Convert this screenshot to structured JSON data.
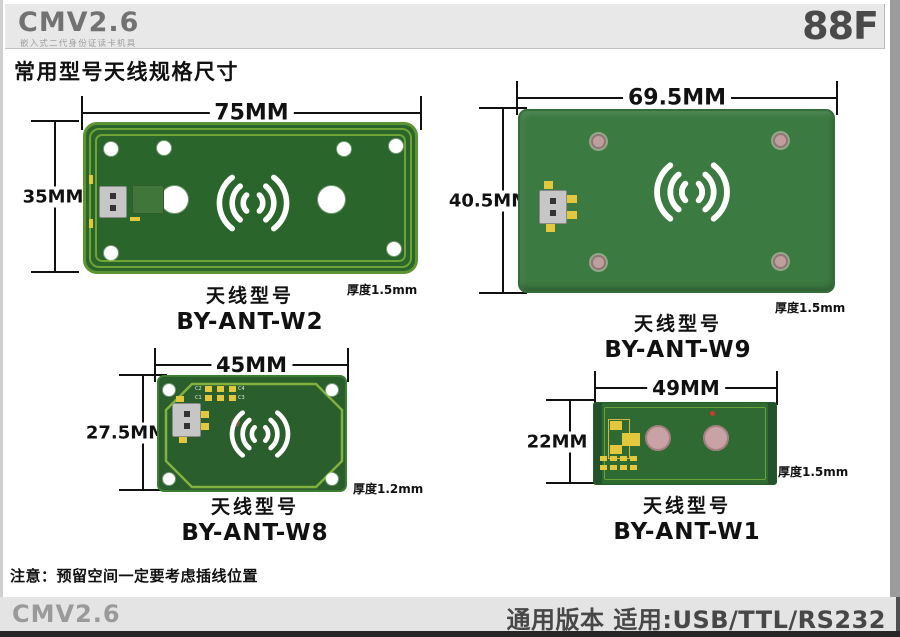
{
  "header": {
    "brand": "CMV2.6",
    "brand_subtitle": "嵌入式二代身份证读卡机具",
    "page_code": "88F"
  },
  "section_title": "常用型号天线规格尺寸",
  "antennas": [
    {
      "model_label": "天线型号",
      "model": "BY-ANT-W2",
      "width": "75MM",
      "height": "35MM",
      "thickness": "厚度1.5mm"
    },
    {
      "model_label": "天线型号",
      "model": "BY-ANT-W9",
      "width": "69.5MM",
      "height": "40.5MM",
      "thickness": "厚度1.5mm"
    },
    {
      "model_label": "天线型号",
      "model": "BY-ANT-W8",
      "width": "45MM",
      "height": "27.5MM",
      "thickness": "厚度1.2mm",
      "pad_labels": [
        "C2",
        "C4",
        "C1",
        "C3"
      ]
    },
    {
      "model_label": "天线型号",
      "model": "BY-ANT-W1",
      "width": "49MM",
      "height": "22MM",
      "thickness": "厚度1.5mm"
    }
  ],
  "note": "注意：预留空间一定要考虑插线位置",
  "footer": {
    "brand": "CMV2.6",
    "version_text": "通用版本 适用:USB/TTL/RS232"
  },
  "colors": {
    "pcb_dark_green": "#2a652c",
    "pcb_mid_green": "#3b7a41",
    "trace_green": "#6fa335",
    "band_gray": "#e8e8e8",
    "brand_gray": "#727272",
    "text_dark": "#111111",
    "pad_yellow": "#e3c83e",
    "hole_bronze": "#bf9e9e"
  }
}
